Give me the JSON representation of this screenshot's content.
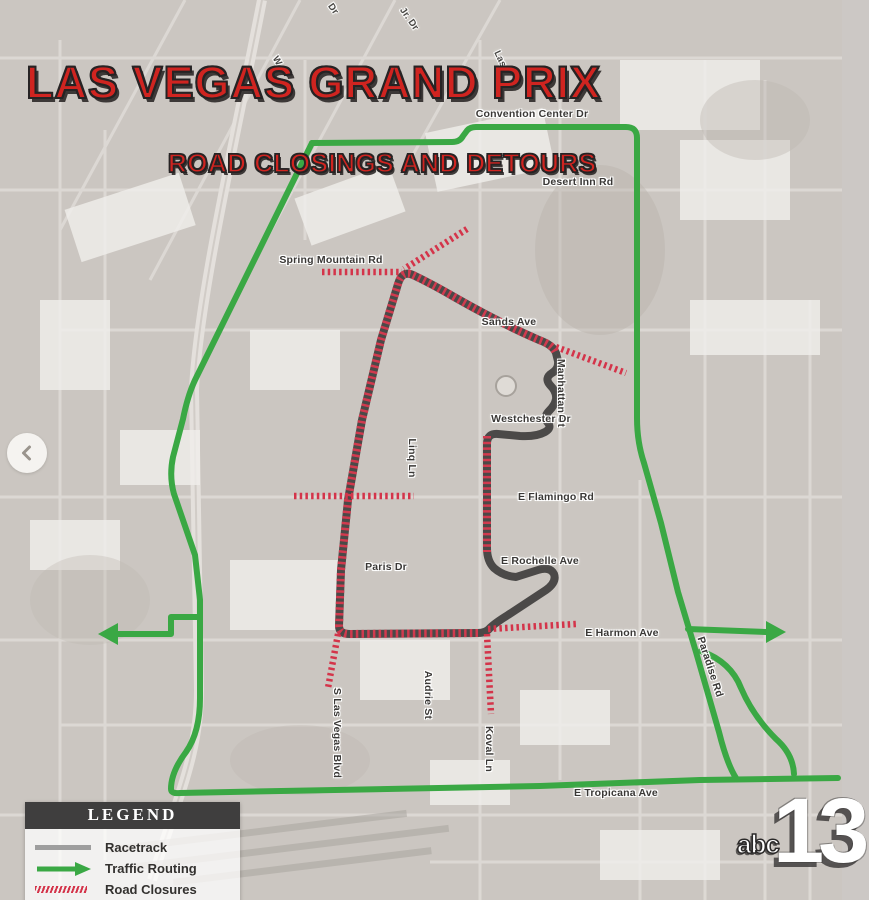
{
  "title": {
    "line1": "LAS VEGAS GRAND PRIX",
    "line2": "ROAD CLOSINGS AND DETOURS"
  },
  "legend": {
    "header": "LEGEND",
    "items": [
      {
        "label": "Racetrack",
        "swatch": "gray-line"
      },
      {
        "label": "Traffic Routing",
        "swatch": "green-arrow"
      },
      {
        "label": "Road Closures",
        "swatch": "red-hatch"
      }
    ]
  },
  "station_logo": {
    "abc": "abc",
    "channel": "13"
  },
  "carousel": {
    "prev_icon": "chevron-left"
  },
  "roads": [
    {
      "text": "Convention Center Dr"
    },
    {
      "text": "Desert Inn Rd"
    },
    {
      "text": "Spring Mountain Rd"
    },
    {
      "text": "Sands Ave"
    },
    {
      "text": "Manhattan St"
    },
    {
      "text": "Westchester Dr"
    },
    {
      "text": "E Flamingo Rd"
    },
    {
      "text": "Linq Ln"
    },
    {
      "text": "Paris Dr"
    },
    {
      "text": "E Rochelle Ave"
    },
    {
      "text": "E Harmon Ave"
    },
    {
      "text": "Paradise Rd"
    },
    {
      "text": "S Las Vegas Blvd"
    },
    {
      "text": "Audrie St"
    },
    {
      "text": "Koval Ln"
    },
    {
      "text": "E Tropicana Ave"
    },
    {
      "text": "Jr. Dr"
    },
    {
      "text": "Dr"
    },
    {
      "text": "W"
    },
    {
      "text": "Las"
    }
  ],
  "colors": {
    "title_red": "#d02420",
    "routing_green": "#3aa844",
    "closure_red": "#d4344a",
    "racetrack_gray": "#4b4948",
    "legend_track_gray": "#9e9e9e",
    "road_label_text": "#3a3836",
    "legend_header_bg": "#3f3e3e",
    "basemap_tone": "#c4beb7"
  }
}
